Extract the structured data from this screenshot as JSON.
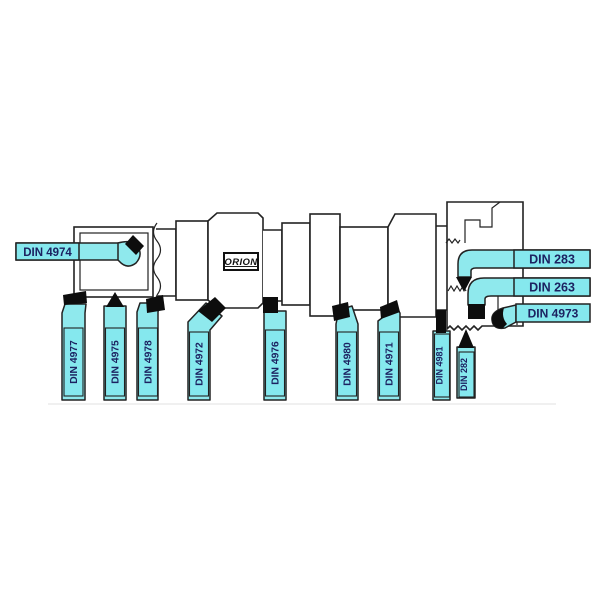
{
  "diagram": {
    "brand": "ORION",
    "colors": {
      "outline": "#222222",
      "tool_fill": "#8fe9ed",
      "label_fill": "#85e8ee",
      "tip": "#0d0d0d",
      "label_text": "#1c2261",
      "background": "#ffffff"
    },
    "labels": {
      "left": "DIN 4974",
      "right": [
        "DIN 283",
        "DIN 263",
        "DIN 4973"
      ],
      "bottom": [
        "DIN 4977",
        "DIN 4975",
        "DIN 4978",
        "DIN 4972",
        "DIN 4976",
        "DIN 4980",
        "DIN 4971",
        "DIN 4981",
        "DIN 282"
      ]
    }
  }
}
